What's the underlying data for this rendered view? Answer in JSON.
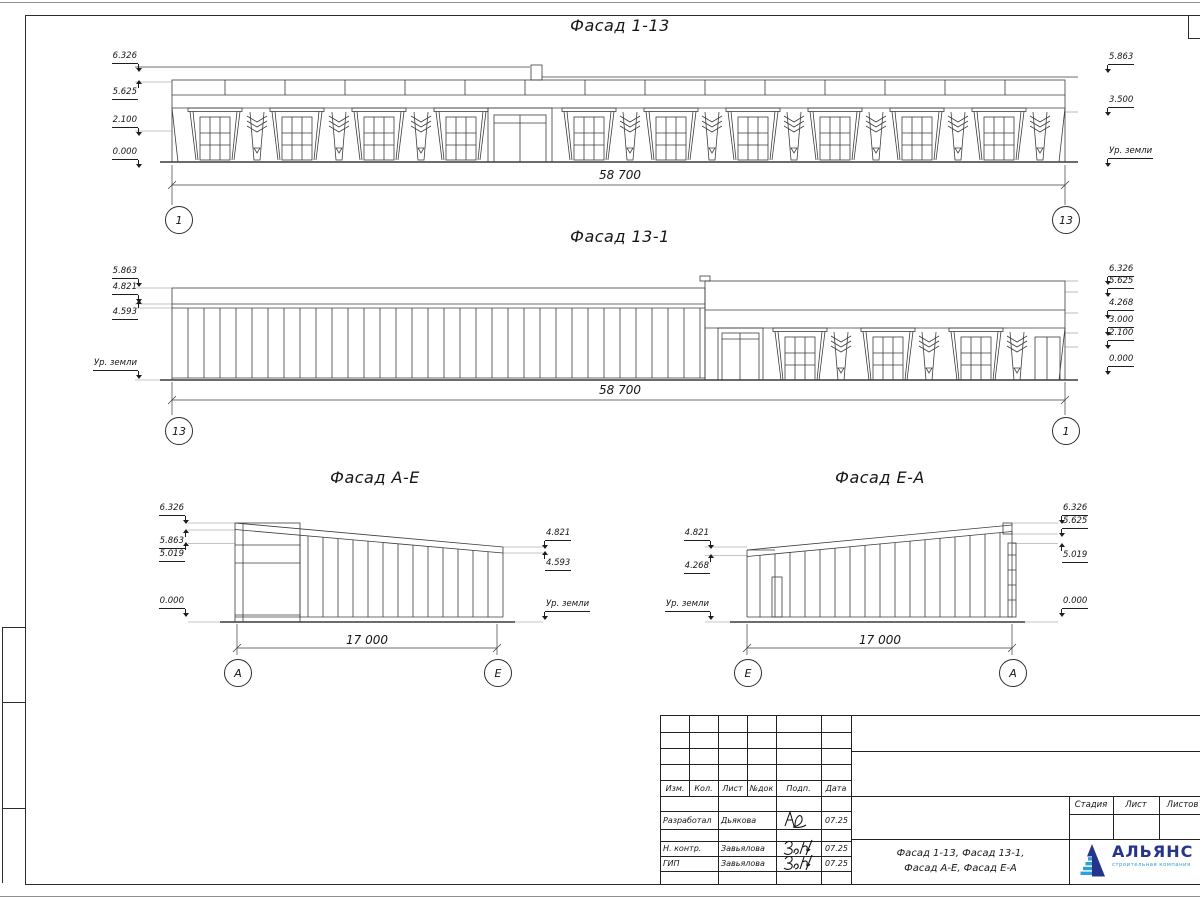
{
  "colors": {
    "line": "#2c2c2c",
    "logo_dark": "#27348b",
    "logo_light": "#2e9fd8"
  },
  "views": [
    {
      "title": "Фасад 1-13",
      "dim": "58 700",
      "axis_left": "1",
      "axis_right": "13",
      "levels_left": [
        "6.326",
        "5.625",
        "2.100",
        "0.000"
      ],
      "levels_right": [
        "5.863",
        "3.500",
        "Ур. земли"
      ]
    },
    {
      "title": "Фасад 13-1",
      "dim": "58 700",
      "axis_left": "13",
      "axis_right": "1",
      "levels_left": [
        "5.863",
        "4.821",
        "4.593",
        "Ур. земли"
      ],
      "levels_right": [
        "6.326",
        "5.625",
        "4.268",
        "3.000",
        "2.100",
        "0.000"
      ]
    },
    {
      "title": "Фасад А-Е",
      "dim": "17 000",
      "axis_left": "А",
      "axis_right": "Е",
      "levels_left": [
        "6.326",
        "5.863",
        "5.019",
        "0.000"
      ],
      "levels_right": [
        "4.821",
        "4.593",
        "Ур. земли"
      ]
    },
    {
      "title": "Фасад Е-А",
      "dim": "17 000",
      "axis_left": "Е",
      "axis_right": "А",
      "levels_left": [
        "4.821",
        "4.268",
        "Ур. земли"
      ],
      "levels_right": [
        "6.326",
        "5.625",
        "5.019",
        "0.000"
      ]
    }
  ],
  "titleblock": {
    "rev_headers": [
      "Изм.",
      "Кол.",
      "Лист",
      "№док",
      "Подп.",
      "Дата"
    ],
    "rows": [
      {
        "role": "Разработал",
        "name": "Дьякова",
        "date": "07.25"
      },
      {
        "role": "Н. контр.",
        "name": "Завьялова",
        "date": "07.25"
      },
      {
        "role": "ГИП",
        "name": "Завьялова",
        "date": "07.25"
      }
    ],
    "doc_line1": "Фасад 1-13, Фасад 13-1,",
    "doc_line2": "Фасад А-Е, Фасад Е-А",
    "stage_headers": [
      "Стадия",
      "Лист",
      "Листов"
    ]
  },
  "logo": {
    "name": "АЛЬЯНС",
    "tagline": "строительная компания"
  }
}
